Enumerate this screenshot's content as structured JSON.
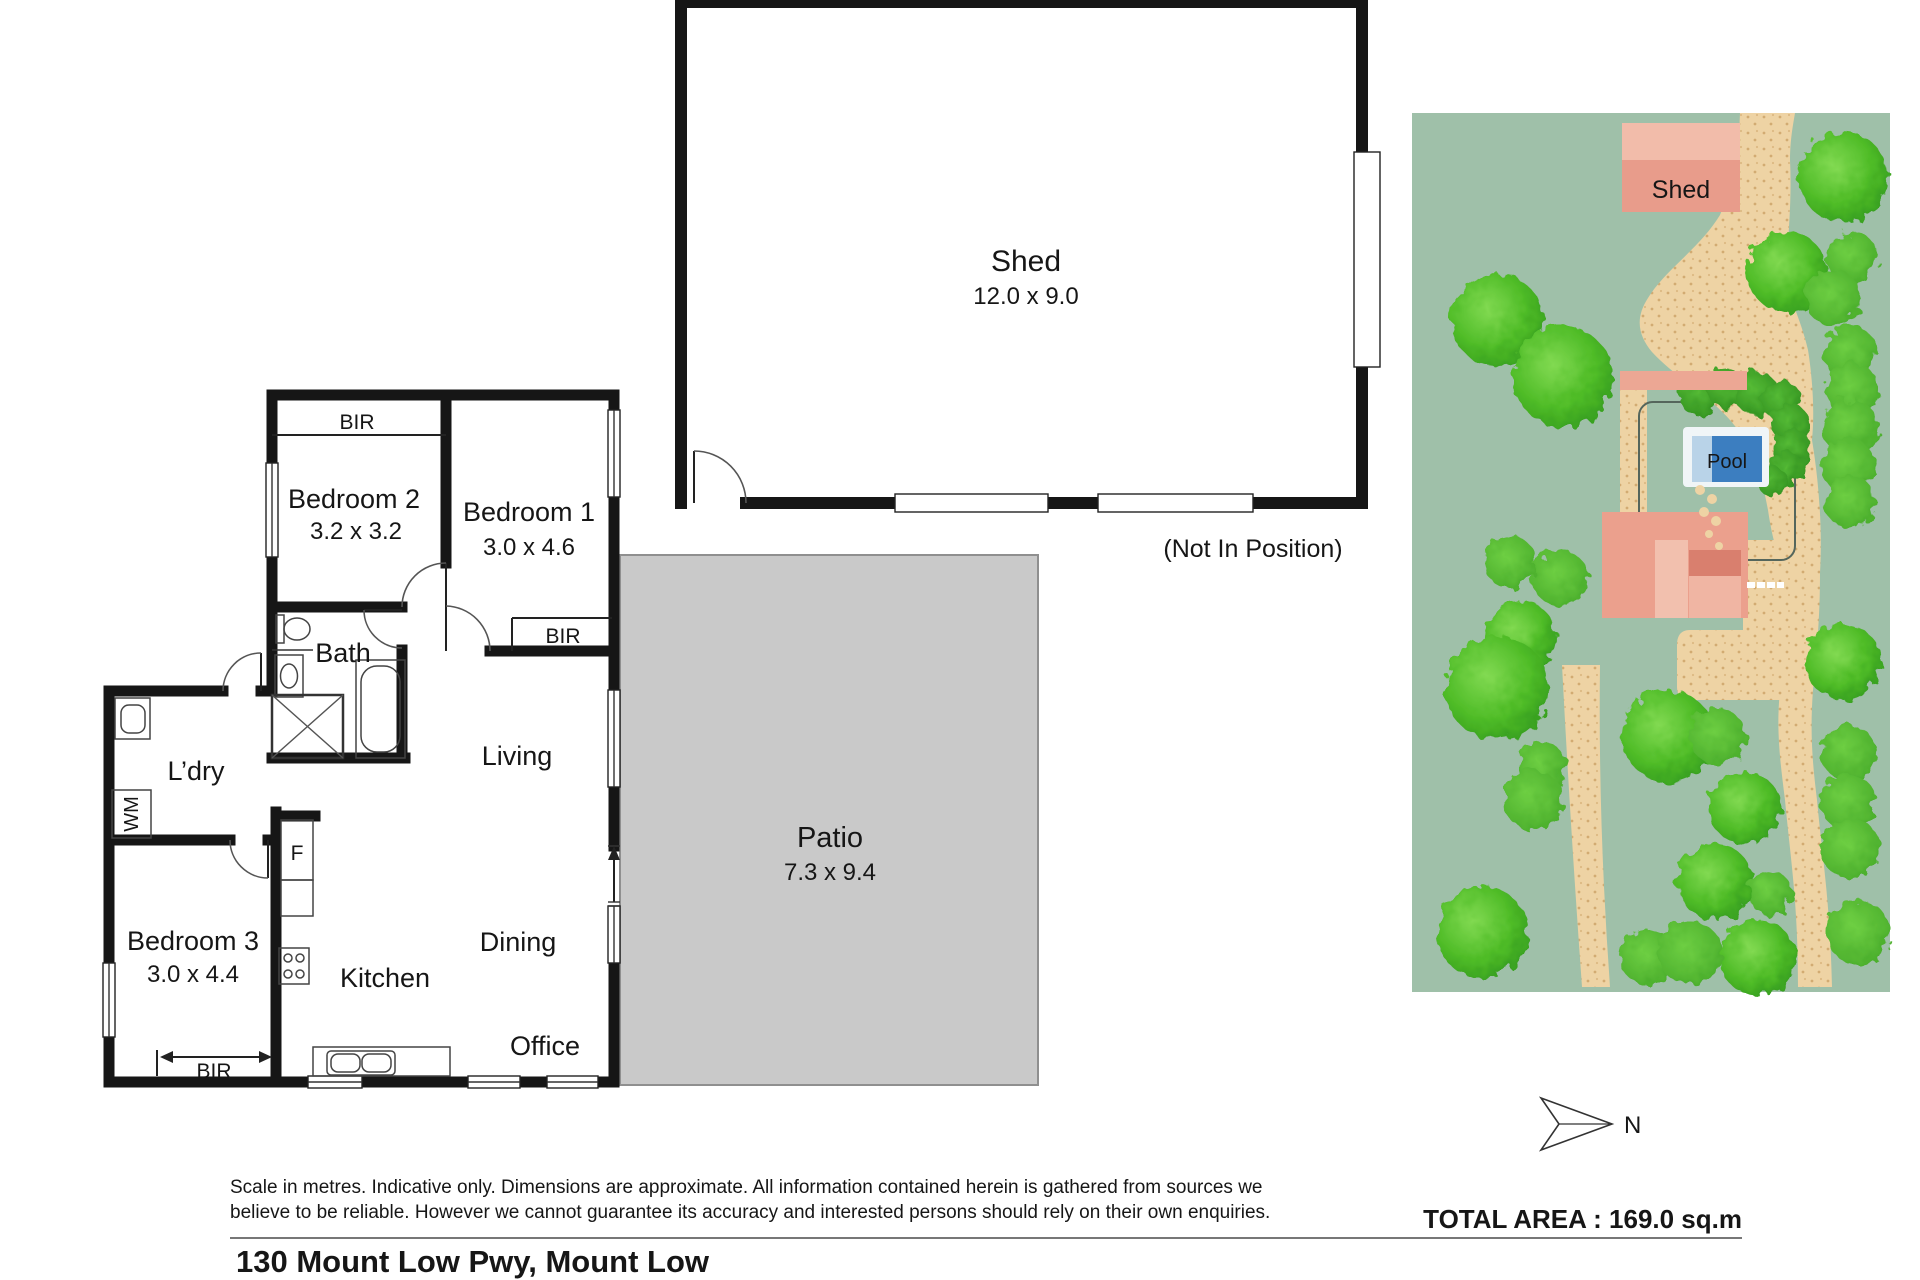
{
  "floorplan": {
    "shed": {
      "label": "Shed",
      "dims": "12.0 x 9.0",
      "note": "(Not In Position)"
    },
    "patio": {
      "label": "Patio",
      "dims": "7.3 x 9.4"
    },
    "bedroom1": {
      "label": "Bedroom 1",
      "dims": "3.0 x 4.6"
    },
    "bedroom2": {
      "label": "Bedroom 2",
      "dims": "3.2 x 3.2"
    },
    "bedroom3": {
      "label": "Bedroom 3",
      "dims": "3.0 x 4.4"
    },
    "bath": {
      "label": "Bath"
    },
    "laundry": {
      "label": "L’dry"
    },
    "living": {
      "label": "Living"
    },
    "dining": {
      "label": "Dining"
    },
    "kitchen": {
      "label": "Kitchen"
    },
    "office": {
      "label": "Office"
    },
    "wardrobe": {
      "label": "BIR"
    },
    "washing_machine": {
      "label": "WM"
    },
    "fridge": {
      "label": "F"
    }
  },
  "siteplan": {
    "shed_label": "Shed",
    "pool_label": "Pool"
  },
  "compass": {
    "north_label": "N"
  },
  "footer": {
    "disclaimer_line1": "Scale in metres. Indicative only. Dimensions are approximate. All information contained herein is gathered from sources we",
    "disclaimer_line2": "believe to be reliable. However we cannot guarantee its accuracy and interested persons should rely on their own enquiries.",
    "total_area": "TOTAL AREA : 169.0 sq.m",
    "address": "130 Mount Low Pwy, Mount Low"
  },
  "colors": {
    "wall": "#161616",
    "patio_fill": "#c9c9c9",
    "site_green": "#9fc0a9",
    "sand": "#eed3a4",
    "building_pink": "#eca794",
    "pool_blue": "#3c7ec0",
    "tree_green": "#4fbc27"
  }
}
